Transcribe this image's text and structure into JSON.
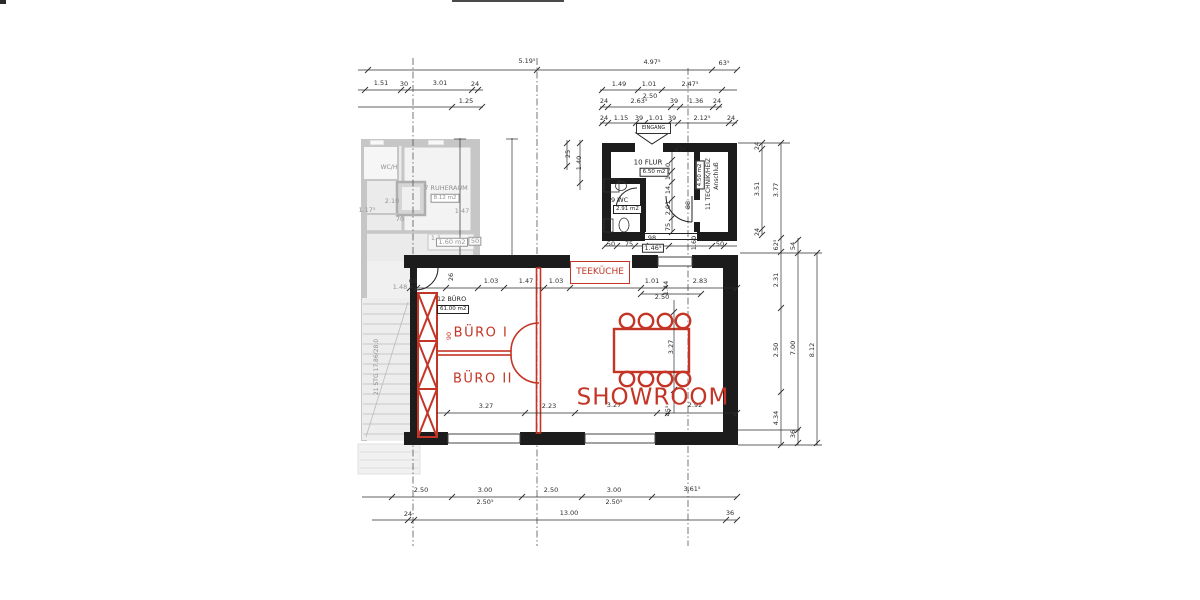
{
  "colors": {
    "annotation_red": "#c43526",
    "wall_black": "#1c1c1c",
    "faded_grey": "#8f8f8f"
  },
  "rooms": {
    "showroom": {
      "label": "SHOWROOM"
    },
    "buero1": {
      "label": "BÜRO I"
    },
    "buero2": {
      "label": "BÜRO II"
    },
    "teekueche": {
      "label": "TEEKÜCHE"
    },
    "buero12": {
      "label": "12 BÜRO",
      "area": "61.00 m2"
    },
    "flur": {
      "label": "10 FLUR",
      "area": "6.50 m2"
    },
    "wc": {
      "label": "9 WC",
      "area": "2.91 m2"
    },
    "technik": {
      "label": "11 TECHNIK/HEIZ",
      "note": "Anschluß",
      "area": "4.50 m2"
    },
    "ruheraum": {
      "label": "7 RUHERAUM",
      "area": "8.12 m2"
    },
    "wc_h": {
      "label": "WC/H"
    },
    "stairs": {
      "label": "21 STG 17.86/28.0"
    },
    "door90": {
      "label": "90"
    },
    "eingang": {
      "label": "EINGANG"
    }
  },
  "dimension_labels": [
    {
      "t": "5.19⁵",
      "x": 527,
      "y": 61
    },
    {
      "t": "4.97⁵",
      "x": 652,
      "y": 62
    },
    {
      "t": "63⁵",
      "x": 724,
      "y": 63
    },
    {
      "t": "1.51",
      "x": 381,
      "y": 83
    },
    {
      "t": "30",
      "x": 404,
      "y": 84
    },
    {
      "t": "3.01",
      "x": 440,
      "y": 83
    },
    {
      "t": "24",
      "x": 475,
      "y": 84
    },
    {
      "t": "1.25",
      "x": 466,
      "y": 101
    },
    {
      "t": "1.49",
      "x": 619,
      "y": 84
    },
    {
      "t": "1.01",
      "x": 649,
      "y": 84
    },
    {
      "t": "2.47⁵",
      "x": 690,
      "y": 84
    },
    {
      "t": "2.50",
      "x": 650,
      "y": 96
    },
    {
      "t": "24",
      "x": 604,
      "y": 101
    },
    {
      "t": "2.63⁵",
      "x": 639,
      "y": 101
    },
    {
      "t": "39",
      "x": 674,
      "y": 101
    },
    {
      "t": "1.36",
      "x": 696,
      "y": 101
    },
    {
      "t": "24",
      "x": 717,
      "y": 101
    },
    {
      "t": "24",
      "x": 604,
      "y": 118
    },
    {
      "t": "1.15",
      "x": 621,
      "y": 118
    },
    {
      "t": "39",
      "x": 639,
      "y": 118
    },
    {
      "t": "1.01",
      "x": 656,
      "y": 118
    },
    {
      "t": "39",
      "x": 672,
      "y": 118
    },
    {
      "t": "2.12⁵",
      "x": 702,
      "y": 118
    },
    {
      "t": "24",
      "x": 731,
      "y": 118
    },
    {
      "t": "67⁵",
      "x": 680,
      "y": 150
    },
    {
      "t": "50",
      "x": 668,
      "y": 167,
      "r": 1
    },
    {
      "t": "19",
      "x": 668,
      "y": 176,
      "r": 1
    },
    {
      "t": "14",
      "x": 668,
      "y": 190,
      "r": 1
    },
    {
      "t": "2.01",
      "x": 668,
      "y": 208,
      "r": 1
    },
    {
      "t": "75",
      "x": 668,
      "y": 227,
      "r": 1
    },
    {
      "t": "88",
      "x": 688,
      "y": 205,
      "r": 1
    },
    {
      "t": "25",
      "x": 568,
      "y": 154,
      "r": 1
    },
    {
      "t": "1.40",
      "x": 579,
      "y": 163,
      "r": 1
    },
    {
      "t": "50",
      "x": 611,
      "y": 244
    },
    {
      "t": "75",
      "x": 629,
      "y": 244
    },
    {
      "t": "98",
      "x": 652,
      "y": 238
    },
    {
      "t": "1.46⁵",
      "x": 653,
      "y": 248,
      "b": 1
    },
    {
      "t": "50",
      "x": 720,
      "y": 244
    },
    {
      "t": "1.60",
      "x": 694,
      "y": 243,
      "r": 1
    },
    {
      "t": "68",
      "x": 413,
      "y": 281
    },
    {
      "t": "26",
      "x": 451,
      "y": 277,
      "r": 1
    },
    {
      "t": "1.03",
      "x": 491,
      "y": 281
    },
    {
      "t": "1.47",
      "x": 526,
      "y": 281
    },
    {
      "t": "1.03",
      "x": 556,
      "y": 281
    },
    {
      "t": "2.98",
      "x": 602,
      "y": 281
    },
    {
      "t": "1.01",
      "x": 652,
      "y": 281
    },
    {
      "t": "1.44",
      "x": 666,
      "y": 288,
      "r": 1
    },
    {
      "t": "2.50",
      "x": 662,
      "y": 297
    },
    {
      "t": "2.83",
      "x": 700,
      "y": 281
    },
    {
      "t": "1.48",
      "x": 400,
      "y": 287,
      "g": 1
    },
    {
      "t": "2.10",
      "x": 392,
      "y": 201,
      "g": 1
    },
    {
      "t": "1.17⁵",
      "x": 367,
      "y": 210,
      "g": 1
    },
    {
      "t": "1.47",
      "x": 462,
      "y": 211,
      "g": 1
    },
    {
      "t": "70",
      "x": 400,
      "y": 219,
      "g": 1
    },
    {
      "t": "1.1",
      "x": 436,
      "y": 238,
      "g": 1
    },
    {
      "t": "1.60 m2",
      "x": 452,
      "y": 242,
      "g": 1,
      "b": 1
    },
    {
      "t": "50",
      "x": 475,
      "y": 241,
      "g": 1,
      "b": 1
    },
    {
      "t": "3.27",
      "x": 486,
      "y": 406
    },
    {
      "t": "2.23",
      "x": 549,
      "y": 406
    },
    {
      "t": "3.27",
      "x": 614,
      "y": 405
    },
    {
      "t": "45⁵",
      "x": 668,
      "y": 411,
      "r": 1
    },
    {
      "t": "2.92",
      "x": 695,
      "y": 405
    },
    {
      "t": "3.27",
      "x": 671,
      "y": 347,
      "r": 1
    },
    {
      "t": "2.50",
      "x": 421,
      "y": 490
    },
    {
      "t": "3.00",
      "x": 485,
      "y": 490
    },
    {
      "t": "2.50⁵",
      "x": 485,
      "y": 502
    },
    {
      "t": "2.50",
      "x": 551,
      "y": 490
    },
    {
      "t": "3.00",
      "x": 614,
      "y": 490
    },
    {
      "t": "2.50⁵",
      "x": 614,
      "y": 502
    },
    {
      "t": "3.61⁵",
      "x": 692,
      "y": 489
    },
    {
      "t": "24",
      "x": 408,
      "y": 514
    },
    {
      "t": "13.00",
      "x": 569,
      "y": 513
    },
    {
      "t": "36",
      "x": 730,
      "y": 513
    },
    {
      "t": "24",
      "x": 757,
      "y": 146,
      "r": 1
    },
    {
      "t": "3.51",
      "x": 757,
      "y": 189,
      "r": 1
    },
    {
      "t": "24",
      "x": 757,
      "y": 232,
      "r": 1
    },
    {
      "t": "3.77",
      "x": 776,
      "y": 190,
      "r": 1
    },
    {
      "t": "62⁵",
      "x": 776,
      "y": 245,
      "r": 1
    },
    {
      "t": "2.31",
      "x": 776,
      "y": 280,
      "r": 1
    },
    {
      "t": "2.50",
      "x": 776,
      "y": 350,
      "r": 1
    },
    {
      "t": "4.34",
      "x": 776,
      "y": 418,
      "r": 1
    },
    {
      "t": "54",
      "x": 793,
      "y": 246,
      "r": 1
    },
    {
      "t": "7.00",
      "x": 793,
      "y": 348,
      "r": 1
    },
    {
      "t": "36",
      "x": 793,
      "y": 434,
      "r": 1
    },
    {
      "t": "8.12",
      "x": 812,
      "y": 350,
      "r": 1
    }
  ]
}
